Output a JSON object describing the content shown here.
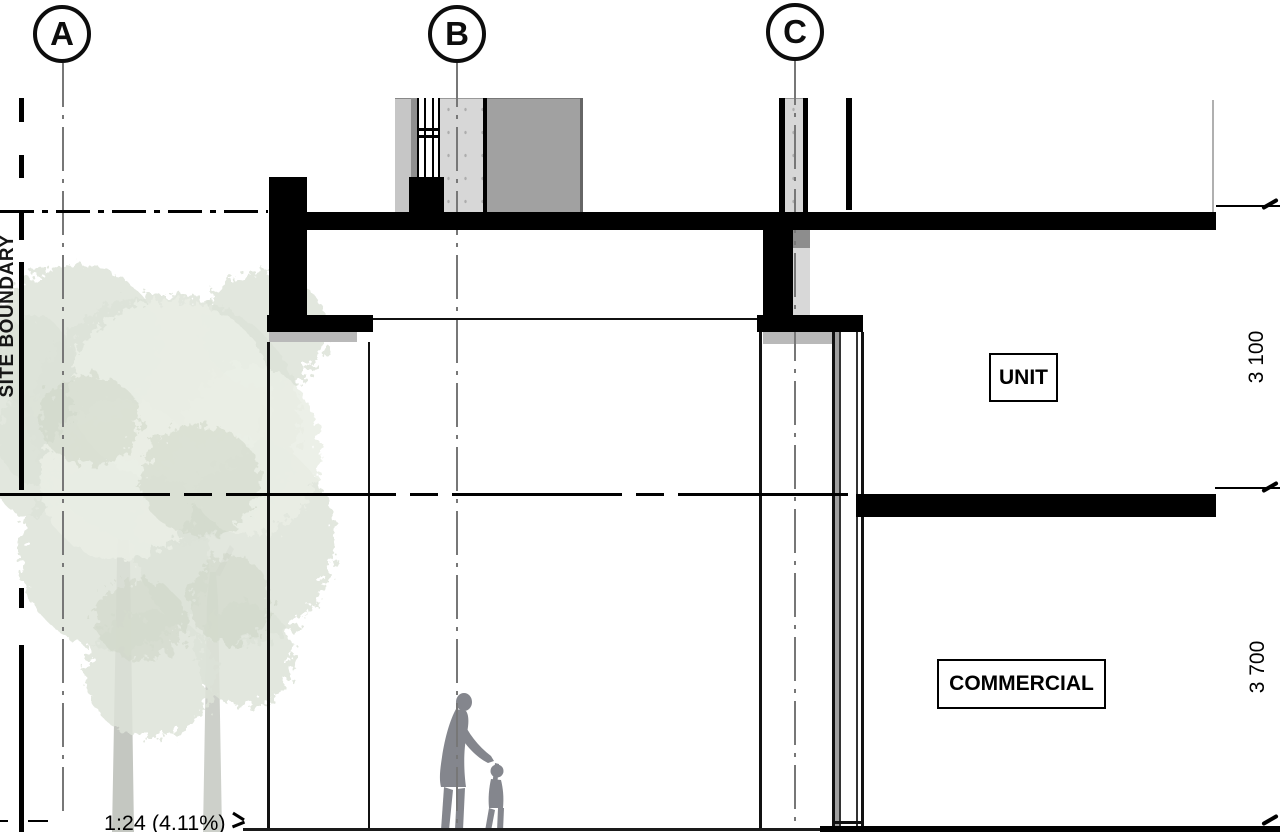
{
  "drawing": {
    "title": "building section detail",
    "grid": {
      "bubbles": [
        {
          "label": "A"
        },
        {
          "label": "B"
        },
        {
          "label": "C"
        }
      ]
    },
    "boundary": {
      "label": "SITE BOUNDARY"
    },
    "rooms": {
      "unit": "UNIT",
      "commercial": "COMMERCIAL"
    },
    "dimensions": {
      "upper_floor_height": "3 100",
      "lower_floor_height": "3 700"
    },
    "annotations": {
      "ramp_slope": "1:24 (4.11%)"
    },
    "colors": {
      "ink": "#000000",
      "concrete": "#d7d7d7",
      "medium_gray": "#a1a1a1",
      "dark_gray": "#8f8f8f",
      "shadow_gray": "#b9b9b9",
      "foliage_green": "#dde3d8",
      "trunk_gray": "#c4c7c1",
      "figure_gray": "#84868d"
    }
  }
}
